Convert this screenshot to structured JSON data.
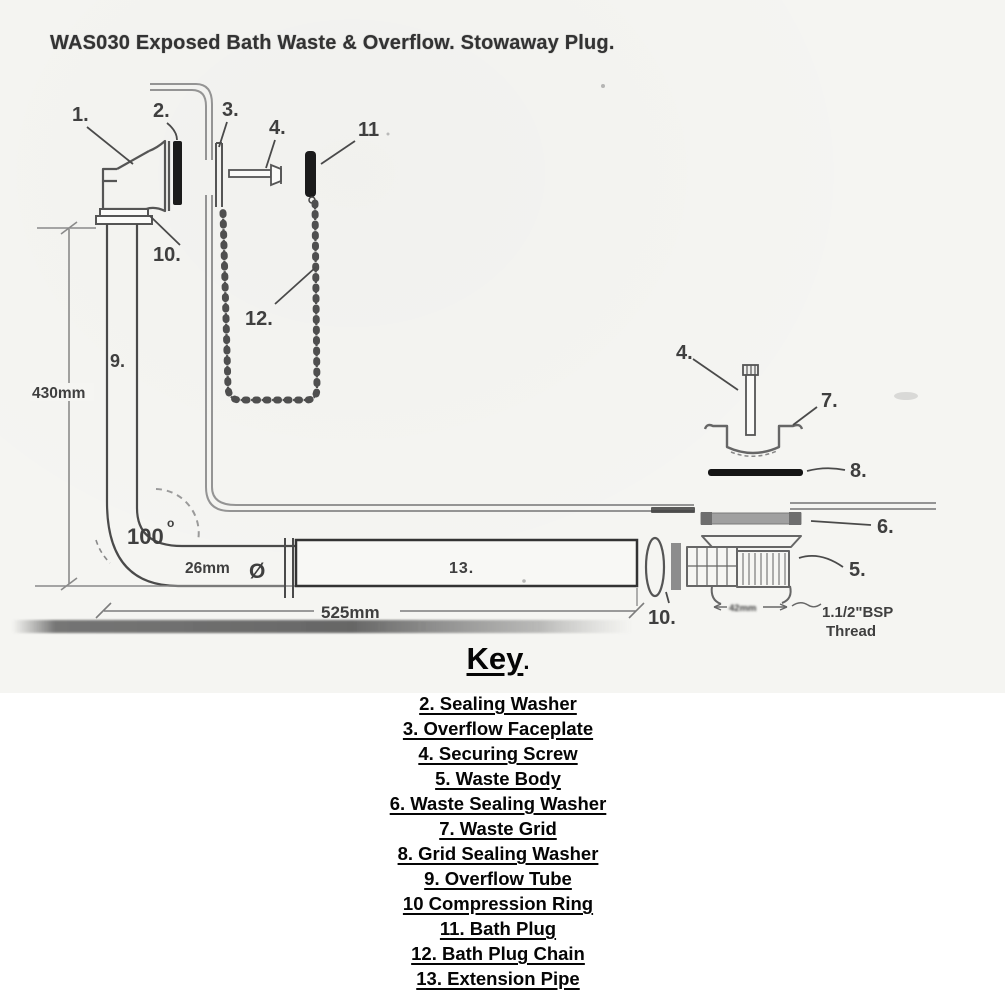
{
  "title": "WAS030 Exposed Bath Waste & Overflow. Stowaway Plug.",
  "diagram": {
    "part_labels": {
      "overflow_elbow": "1.",
      "sealing_washer": "2.",
      "overflow_faceplate": "3.",
      "securing_screw_top": "4.",
      "securing_screw_right": "4.",
      "waste_body": "5.",
      "waste_sealing_washer": "6.",
      "waste_grid": "7.",
      "grid_sealing_washer": "8.",
      "overflow_tube": "9.",
      "compression_ring_top": "10.",
      "compression_ring_right": "10.",
      "bath_plug": "11",
      "bath_plug_chain": "12.",
      "extension_pipe": "13."
    },
    "dimensions": {
      "tube_height": "430mm",
      "pipe_length": "525mm",
      "tube_diameter": "26mm",
      "diameter_symbol": "Ø",
      "bend_angle": "100",
      "bend_angle_sup": "o",
      "waste_outlet": "42mm",
      "thread_line1": "1.1/2\"BSP",
      "thread_line2": "Thread"
    }
  },
  "key": {
    "heading": "Key",
    "heading_period": ".",
    "items": [
      "2. Sealing Washer",
      "3. Overflow Faceplate",
      "4. Securing Screw",
      "5. Waste Body",
      "6. Waste Sealing Washer",
      "7. Waste Grid",
      "8. Grid Sealing Washer",
      "9. Overflow Tube",
      "10 Compression Ring",
      "11. Bath Plug",
      "12. Bath Plug Chain",
      "13. Extension Pipe"
    ]
  }
}
